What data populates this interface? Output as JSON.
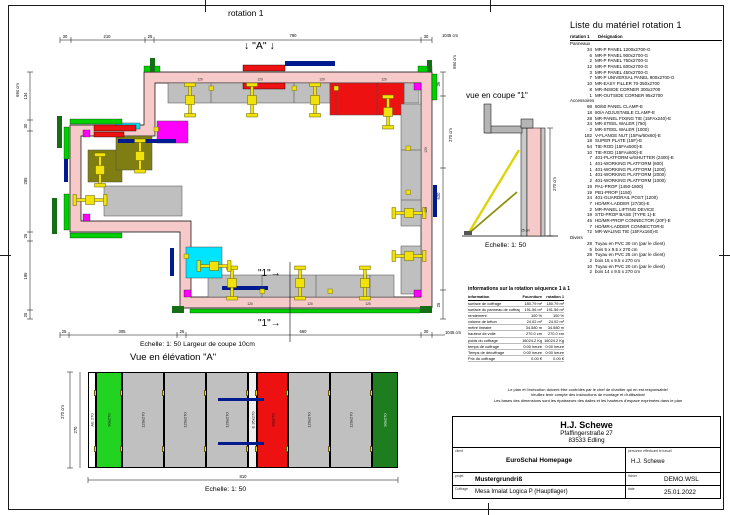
{
  "sheet": {
    "plan_title": "rotation 1",
    "marker_a": "↓ \"A\" ↓",
    "marker_1": "\"1\"→",
    "plan_scale": "Echelle: 1: 50   Largeur de coupe 10cm",
    "elevation_title": "Vue en élévation \"A\"",
    "scale_label": "Echelle: 1: 50",
    "section_title": "vue en coupe \"1\"",
    "section_thickness": "25 cm"
  },
  "plan_dims": {
    "top": [
      "30",
      "210",
      "25",
      "780",
      "30"
    ],
    "left": [
      "134",
      "30",
      "285",
      "25",
      "195",
      "25"
    ],
    "bottom": [
      "25",
      "305",
      "25",
      "660",
      "30"
    ],
    "right": [
      "36",
      "270 cm",
      "620",
      "25"
    ],
    "total_width": "1045 cm",
    "total_height": "694 cm",
    "panel_label": "120"
  },
  "elevation": {
    "dim_total": "270 cm",
    "dim_inner": "270",
    "dim_width": "810",
    "panels": [
      {
        "label": "AE 270",
        "color": "#ffffff",
        "w": 8
      },
      {
        "label": "90x270",
        "color": "#21d421",
        "w": 26
      },
      {
        "label": "120x270",
        "color": "#c0c0c0",
        "w": 42
      },
      {
        "label": "120x270",
        "color": "#c0c0c0",
        "w": 42
      },
      {
        "label": "120x270",
        "color": "#c0c0c0",
        "w": 42
      },
      {
        "label": "E 35x270",
        "color": "#f0f0f0",
        "w": 9
      },
      {
        "label": "90x270",
        "color": "#ee1111",
        "w": 31
      },
      {
        "label": "120x270",
        "color": "#c0c0c0",
        "w": 42
      },
      {
        "label": "120x270",
        "color": "#c0c0c0",
        "w": 42
      },
      {
        "label": "90x270",
        "color": "#1e7d1e",
        "w": 26
      }
    ]
  },
  "section": {
    "dim_height": "270 cm"
  },
  "material": {
    "title": "Liste du matériel  rotation 1",
    "header_col1": "rotation 1",
    "header_col2": "Désignation",
    "sections": [
      {
        "name": "Panneaux",
        "items": [
          {
            "qty": "34",
            "label": "MR-P PANEL 1200x2700-G"
          },
          {
            "qty": "6",
            "label": "MR-P PANEL 900x2700-G"
          },
          {
            "qty": "2",
            "label": "MR-P PANEL 750x2700-G"
          },
          {
            "qty": "12",
            "label": "MR-P PANEL 600x2700-G"
          },
          {
            "qty": "3",
            "label": "MR-P PANEL 450x2700-G"
          },
          {
            "qty": "7",
            "label": "MR-P UNIVERSAL PANEL 900x2700-G"
          },
          {
            "qty": "10",
            "label": "MR-EASY FILLER 70-350x2700"
          },
          {
            "qty": "8",
            "label": "MR-INSIDE CORNER 300x2700"
          },
          {
            "qty": "1",
            "label": "MR-OUTSIDE CORNER 95x2700"
          }
        ]
      },
      {
        "name": "Accessoires",
        "items": [
          {
            "qty": "98",
            "label": "80/60 PANEL CLAMP-E"
          },
          {
            "qty": "18",
            "label": "80/A ADJUSTABLE CLAMP-E"
          },
          {
            "qty": "28",
            "label": "MR-PANEL FIXING TIE (15FAx240)-E"
          },
          {
            "qty": "34",
            "label": "MR-STEEL WALER (750)"
          },
          {
            "qty": "2",
            "label": "MR-STEEL WALER (1000)"
          },
          {
            "qty": "182",
            "label": "V-FLANGE NUT (15Fw/60x60)-E"
          },
          {
            "qty": "18",
            "label": "SUPER PLATE (15F)-E"
          },
          {
            "qty": "54",
            "label": "TIE-ROD (15FAx500)-E"
          },
          {
            "qty": "10",
            "label": "TIE-ROD (15FAx600)-E"
          },
          {
            "qty": "7",
            "label": "401-PLATFORM w/SHUTTER (2400)-E"
          },
          {
            "qty": "1",
            "label": "401-WORKING PLATFORM (600)"
          },
          {
            "qty": "1",
            "label": "401-WORKING PLATFORM (1200)"
          },
          {
            "qty": "1",
            "label": "401-WORKING PLATFORM (2000)"
          },
          {
            "qty": "2",
            "label": "401-WORKING PLATFORM (1000)"
          },
          {
            "qty": "19",
            "label": "PA1-PROP (1450-1800)"
          },
          {
            "qty": "19",
            "label": "PB1-PROP (1150)"
          },
          {
            "qty": "24",
            "label": "401-GUARDRAIL POST (1200)"
          },
          {
            "qty": "7",
            "label": "HD/MR-LADDER (27/30)-E"
          },
          {
            "qty": "2",
            "label": "MR-PANEL LIFTING DEVICE"
          },
          {
            "qty": "19",
            "label": "STD-PROP BASE (TYPE 1)-E"
          },
          {
            "qty": "45",
            "label": "HD/MR-PROP CONNECTOR (20F)-E"
          },
          {
            "qty": "7",
            "label": "HD/MR-LADDER CONNECTOR-E"
          },
          {
            "qty": "72",
            "label": "MR-WALING TIE (15FAx160)-E"
          }
        ]
      },
      {
        "name": "Divers",
        "items": [
          {
            "qty": "28",
            "label": "Tuyau en PVC 30 cm (par le client)"
          },
          {
            "qty": "5",
            "label": "bois 5 x 9.5 x 270 cm"
          },
          {
            "qty": "28",
            "label": "Tuyau en PVC 25 cm (par le client)"
          },
          {
            "qty": "2",
            "label": "bois 15 x 9.5 x 270 cm"
          },
          {
            "qty": "10",
            "label": "Tuyau en PVC 20 cm (par le client)"
          },
          {
            "qty": "2",
            "label": "bois 14 x 9.5 x 270 cm"
          }
        ]
      }
    ]
  },
  "info": {
    "title": "informations sur la rotation  séquence 1 à 1",
    "headers": [
      "information",
      "Fourniture",
      "rotation 1"
    ],
    "rows": [
      [
        "surface de coffrage",
        "180.79 m²",
        "180.79 m²"
      ],
      [
        "surface du panneau de coffrage",
        "191.56 m²",
        "191.56 m²"
      ],
      [
        "rendement",
        "100 %",
        "100 %"
      ],
      [
        "volume de béton",
        "24.02 m³",
        "24.02 m³"
      ],
      [
        "mètre linéaire",
        "34.580 m",
        "34.580 m"
      ],
      [
        "hauteur de voile",
        "270.0 cm",
        "270.0 cm"
      ],
      [
        "poids du coffrage",
        "16024.2 Kg",
        "16024.2 Kg"
      ],
      [
        "temps de coffrage",
        "0:00 heure",
        "0:00 heure"
      ],
      [
        "Temps de décoffrage",
        "0:00 heure",
        "0:00 heure"
      ],
      [
        "Prix du coffrage",
        "0.00 €",
        "0.00 €"
      ]
    ]
  },
  "notes": [
    "Le plan et l'exécution doivent être contrôlés par le chef de chantier qui en est responsable!",
    "Veuillez tenir compte des instructions de montage et d'utilisation!",
    "Les bases des dimensions sont les épaisseurs des dalles et les hauteurs d'espace exprimées dans le plan"
  ],
  "titleblock": {
    "company": "H.J. Schewe",
    "street": "Pfaffingerstraße 27",
    "city": "83533 Edling",
    "client_label": "client",
    "client": "EuroSchal Homepage",
    "worker_label": "personne effectuant le travail",
    "worker": "H.J. Schewe",
    "project_label": "projet",
    "project": "Mustergrundriß",
    "file_label": "fichier",
    "file": "DEMO.WSL",
    "formwork_label": "Coffrage",
    "formwork": "Mesa Imalat Logica P (Hauptlager)",
    "date_label": "date",
    "date": "25.01.2022"
  },
  "colors": {
    "wall": "#f7caca",
    "panel_gray": "#bfbfbf",
    "accent_red": "#ee1111",
    "accent_magenta": "#ff00ff",
    "accent_cyan": "#00e5ff",
    "accent_olive": "#7e7e12",
    "accent_green": "#00cf00",
    "accent_darkgreen": "#156e15",
    "tie_yellow": "#f0e20a",
    "waler_navy": "#001a8f"
  }
}
